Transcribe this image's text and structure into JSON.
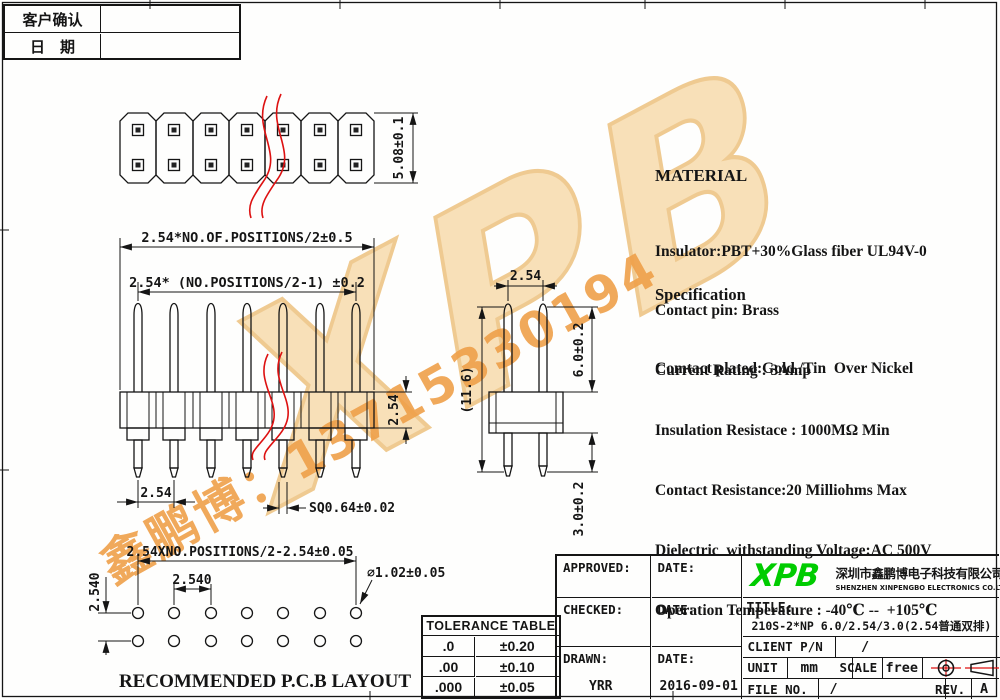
{
  "customer_table": {
    "row1_label": "客户确认",
    "row2_label": "日　期"
  },
  "top_view": {
    "dim_height": "5.08±0.1"
  },
  "side_view": {
    "dim_overall": "2.54*NO.OF.POSITIONS/2±0.5",
    "dim_inner": "2.54* (NO.POSITIONS/2-1) ±0.2",
    "dim_pitch": "2.54",
    "dim_square": "SQ0.64±0.02",
    "dim_base_height": "2.54"
  },
  "right_view": {
    "dim_pitch": "2.54",
    "dim_total": "(11.6)",
    "dim_upper": "6.0±0.2",
    "dim_lower": "3.0±0.2"
  },
  "material": {
    "heading": "MATERIAL",
    "lines": [
      "Insulator:PBT+30%Glass fiber UL94V-0",
      "Contact pin: Brass",
      "Comtact plated:Gold /Tin  Over Nickel"
    ]
  },
  "specification": {
    "heading": "Specification",
    "lines": [
      "Current Rating : 3Amp",
      "Insulation Resistace : 1000MΩ Min",
      "Contact Resistance:20 Milliohms Max",
      "Dielectric  withstanding Voltage:AC 500V",
      "Operation Temperature : -40℃ --  +105℃"
    ]
  },
  "pcb_layout": {
    "dim_overall": "2.54XNO.POSITIONS/2-2.54±0.05",
    "dim_pitch_h": "2.540",
    "dim_pitch_v": "2.540",
    "dim_hole": "∅1.02±0.05",
    "caption": "RECOMMENDED P.C.B LAYOUT"
  },
  "tolerance_table": {
    "title": "TOLERANCE TABLE",
    "rows": [
      {
        "digits": ".0",
        "tol": "±0.20"
      },
      {
        "digits": ".00",
        "tol": "±0.10"
      },
      {
        "digits": ".000",
        "tol": "±0.05"
      }
    ]
  },
  "title_block": {
    "approved_label": "APPROVED:",
    "checked_label": "CHECKED:",
    "drawn_label": "DRAWN:",
    "date_label": "DATE:",
    "drawn_value": "YRR",
    "drawn_date": "2016-09-01",
    "logo_text": "XPB",
    "company_cn": "深圳市鑫鹏博电子科技有限公司",
    "company_en": "SHENZHEN XINPENGBO ELECTRONICS CO.LTD",
    "title_label": "TITLE:",
    "title_value": "210S-2*NP 6.0/2.54/3.0(2.54普通双排)",
    "client_pn_label": "CLIENT P/N",
    "client_pn_value": "/",
    "unit_label": "UNIT",
    "unit_value": "mm",
    "scale_label": "SCALE",
    "scale_value": "free",
    "file_no_label": "FILE NO.",
    "file_no_value": "/",
    "rev_label": "REV.",
    "rev_value": "A"
  },
  "watermark": {
    "logo_text": "XPB",
    "phone_text": "鑫鹏博：13715330194"
  },
  "colors": {
    "line": "#151515",
    "red": "#dd1111",
    "green": "#00cc00",
    "watermark_fill": "#f6d7a2",
    "watermark_text": "#efa04a"
  }
}
